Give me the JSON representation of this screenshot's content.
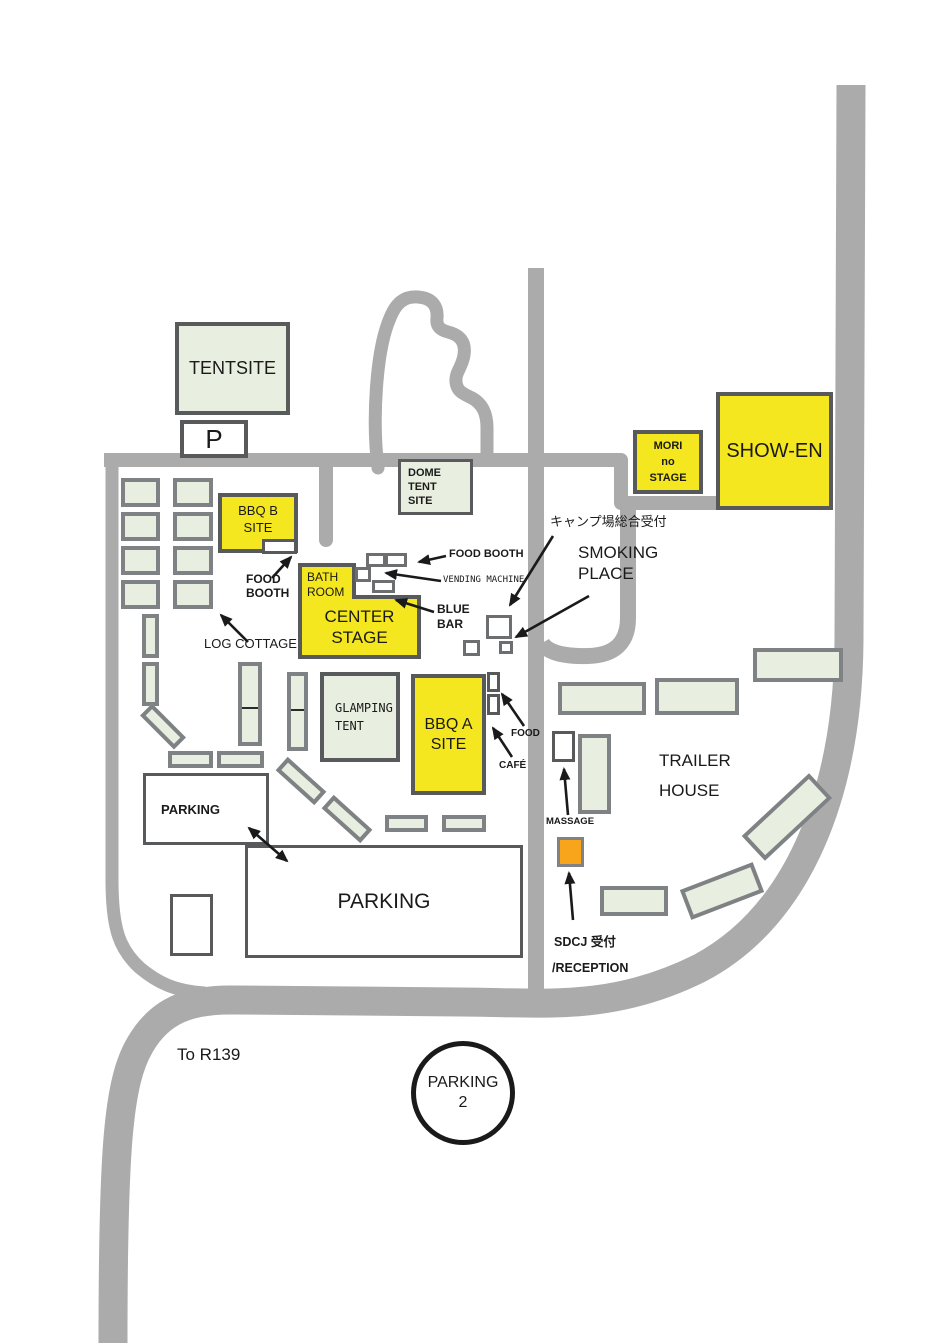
{
  "map_title": "Campsite / festival site map",
  "colors": {
    "road": "#ABABAB",
    "yellow_area": "#F4E71F",
    "green_area": "#E9EFE0",
    "dark_border": "#58595B",
    "gray_border": "#7F8284",
    "orange_area": "#F9A51B",
    "arrow": "#1A1A1A"
  },
  "areas": {
    "tentsite": {
      "label": "TENTSITE"
    },
    "parking_p": {
      "label": "P"
    },
    "dome_tent_site": {
      "label": "DOME\nTENT\nSITE"
    },
    "bbq_b_site": {
      "label": "BBQ B\nSITE"
    },
    "mori_no_stage": {
      "label": "MORI\nno\nSTAGE"
    },
    "show_en": {
      "label": "SHOW-EN"
    },
    "bath_room": {
      "label": "BATH\nROOM"
    },
    "center_stage": {
      "label": "CENTER\nSTAGE"
    },
    "glamping_tent": {
      "label": "GLAMPING\nTENT"
    },
    "bbq_a_site": {
      "label": "BBQ A\nSITE"
    },
    "parking_small": {
      "label": "PARKING"
    },
    "parking_large": {
      "label": "PARKING"
    },
    "parking_2": {
      "label": "PARKING",
      "number": "2"
    }
  },
  "annotations": {
    "camp_reception": "キャンプ場総合受付",
    "smoking_place": "SMOKING\nPLACE",
    "log_cottage": "LOG COTTAGE",
    "food_booth_bbqb": "FOOD\nBOOTH",
    "food_booth_center": "FOOD BOOTH",
    "vending_machine": "VENDING MACHINE",
    "blue_bar": "BLUE\nBAR",
    "food": "FOOD",
    "cafe": "CAFÉ",
    "trailer_house": "TRAILER\nHOUSE",
    "massage": "MASSAGE",
    "sdcj_reception": "SDCJ 受付",
    "reception": "/RECEPTION",
    "to_r139": "To R139"
  }
}
